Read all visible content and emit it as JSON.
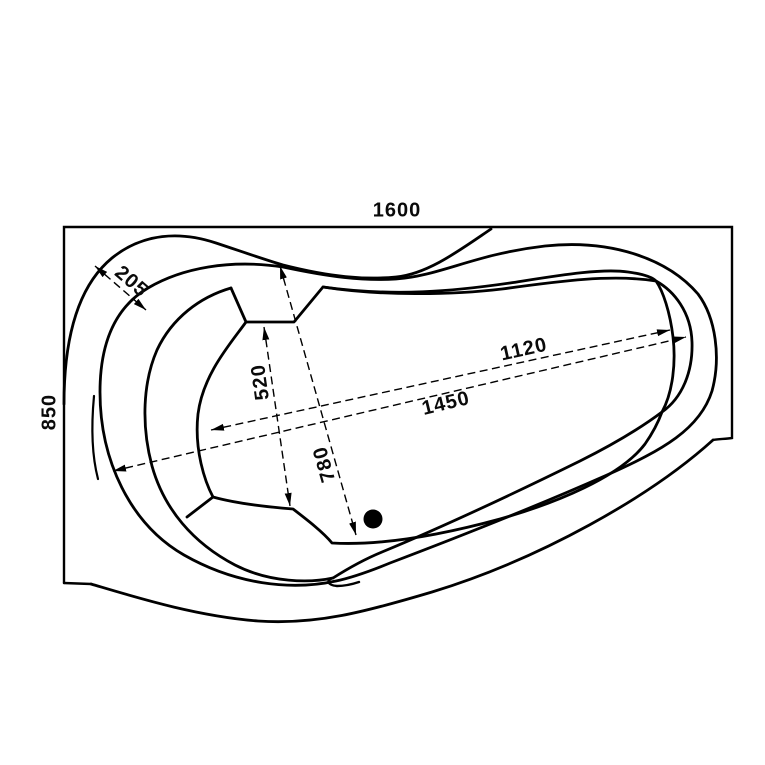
{
  "page": {
    "background": "#ffffff",
    "line_color": "#000000"
  },
  "dimensions": {
    "overall_width": "1600",
    "overall_depth": "850",
    "corner_rim_width": "205",
    "headrest_to_seat": "520",
    "rim_to_front_inner": "780",
    "basin_length": "1120",
    "overall_inner_length": "1450"
  }
}
